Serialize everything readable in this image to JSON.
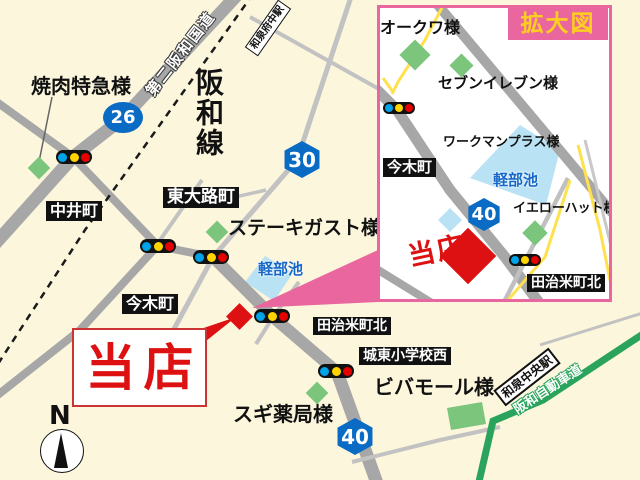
{
  "main_map": {
    "compass_label": "N",
    "route_badges": {
      "r26": "26",
      "r30": "30",
      "r40": "40"
    },
    "railway_name": "阪和線",
    "road_name": "第二阪和国道",
    "expressway_name": "阪和自動車道",
    "stations": {
      "izumi_fuchu": "和泉府中駅",
      "izumi_chuo": "和泉中央駅"
    },
    "area_labels": {
      "nakai": "中井町",
      "higashioji": "東大路町",
      "imaki": "今木町",
      "tajime_kita": "田治米町北",
      "joto_elementary_west": "城東小学校西"
    },
    "businesses": {
      "yakiniku_tokkyu": "焼肉特急様",
      "steak_gusto": "ステーキガスト様",
      "sugi_pharmacy": "スギ薬局様",
      "viva_mall": "ビバモール様"
    },
    "pond_name": "軽部池",
    "store_label": "当店"
  },
  "inset": {
    "title": "拡大図",
    "route_badge_40": "40",
    "area_labels": {
      "imaki": "今木町",
      "tajime_kita": "田治米町北"
    },
    "businesses": {
      "okuwa": "オークワ様",
      "seven_eleven": "セブンイレブン様",
      "workman_plus": "ワークマンプラス様",
      "yellow_hat": "イエローハット様"
    },
    "pond_name": "軽部池",
    "store_label": "当店"
  },
  "colors": {
    "accent_pink": "#e9679e",
    "route_blue": "#0a6bc4",
    "store_red": "#dd1111",
    "expressway_green": "#2aa45c",
    "pond_blue": "#b9e2f4",
    "road_gray": "#a7a7a7",
    "background_cream": "#fbf6dc"
  }
}
